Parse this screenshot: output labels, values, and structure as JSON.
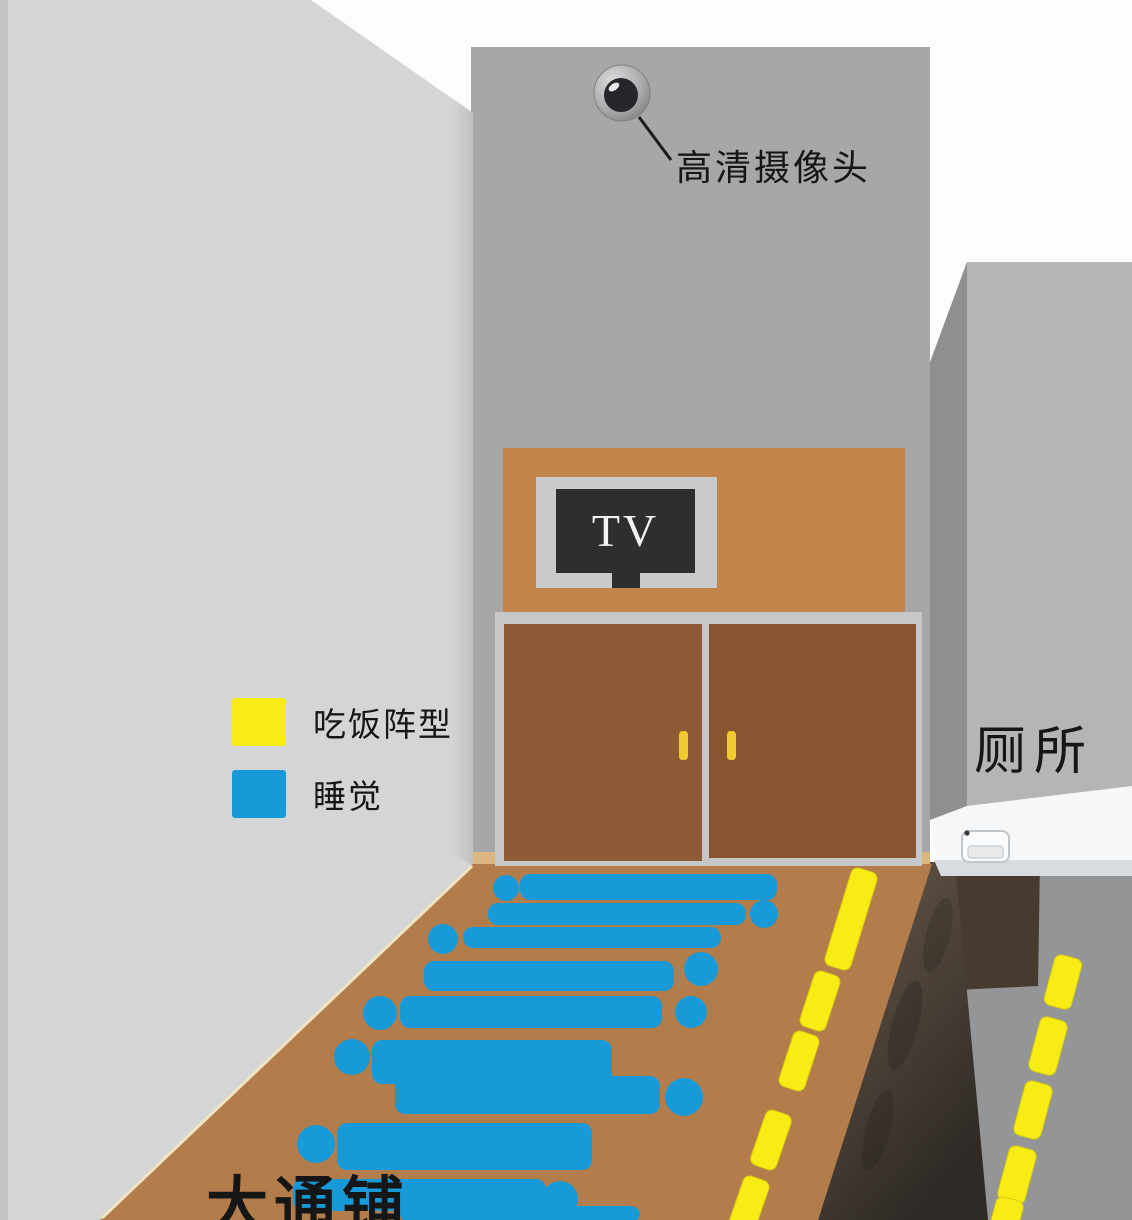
{
  "labels": {
    "camera": "高清摄像头",
    "tv": "TV",
    "toilet": "厕所",
    "communal_bed": "大通铺"
  },
  "legend": {
    "items": [
      {
        "label": "吃饭阵型",
        "color_key": "eat_yellow"
      },
      {
        "label": "睡觉",
        "color_key": "sleep_blue"
      }
    ]
  },
  "colors": {
    "background": "#fdfdfd",
    "wall_left": "#d4d5d7",
    "wall_left_edge": "#c3c4c6",
    "wall_back": "#a6a7a9",
    "wall_right_front": "#b4b5b7",
    "wall_right_side": "#8e8f91",
    "tv_panel": "#c28449",
    "tv_bezel": "#c9cacc",
    "tv_screen": "#2d2e30",
    "door_frame": "#c6c7c9",
    "door_left": "#8d5c37",
    "door_right": "#875631",
    "door_handle": "#f0cb30",
    "floor": "#b27d4b",
    "floor_sill": "#dcb67f",
    "floor_edge_highlight": "#f0e4c2",
    "under_counter": "#473b2f",
    "ground": "#939597",
    "counter": "#f5f7f9",
    "counter_edge": "#d9dcde",
    "toilet_body": "#fbfcfd",
    "toilet_inner": "#e8eaec",
    "sleep_blue": "#189ad8",
    "eat_yellow": "#f7ed15",
    "camera_lens": "#26272a",
    "text": "#161616"
  },
  "scene": {
    "sleepers": [
      {
        "head": [
          506,
          888,
          13
        ],
        "body": [
          520,
          874,
          257,
          26
        ]
      },
      {
        "body": [
          488,
          903,
          258,
          22
        ],
        "head": [
          764,
          914,
          14
        ]
      },
      {
        "head": [
          443,
          939,
          15
        ],
        "body": [
          463,
          927,
          258,
          21
        ]
      },
      {
        "body": [
          424,
          961,
          250,
          30
        ],
        "head": [
          701,
          969,
          17
        ]
      },
      {
        "head": [
          380,
          1013,
          17
        ],
        "body": [
          400,
          996,
          262,
          32
        ]
      },
      {
        "head": [
          691,
          1012,
          16
        ]
      },
      {
        "head": [
          352,
          1057,
          18
        ],
        "body": [
          372,
          1040,
          240,
          44
        ]
      },
      {
        "body": [
          395,
          1076,
          265,
          38
        ],
        "head": [
          684,
          1097,
          19
        ]
      },
      {
        "head": [
          316,
          1144,
          19
        ],
        "body": [
          337,
          1123,
          255,
          47
        ]
      },
      {
        "body": [
          293,
          1179,
          253,
          32
        ],
        "head": [
          560,
          1199,
          18
        ]
      },
      {
        "body": [
          400,
          1206,
          240,
          16
        ]
      }
    ],
    "eating_dashes": [
      {
        "cx": 851,
        "cy": 919,
        "w": 27,
        "h": 102,
        "angle": 17
      },
      {
        "cx": 820,
        "cy": 1001,
        "w": 27,
        "h": 58,
        "angle": 18
      },
      {
        "cx": 799,
        "cy": 1061,
        "w": 27,
        "h": 58,
        "angle": 18
      },
      {
        "cx": 771,
        "cy": 1140,
        "w": 27,
        "h": 58,
        "angle": 19
      },
      {
        "cx": 749,
        "cy": 1205,
        "w": 27,
        "h": 56,
        "angle": 19
      },
      {
        "cx": 1063,
        "cy": 982,
        "w": 28,
        "h": 52,
        "angle": 15
      },
      {
        "cx": 1048,
        "cy": 1046,
        "w": 28,
        "h": 56,
        "angle": 15
      },
      {
        "cx": 1033,
        "cy": 1110,
        "w": 28,
        "h": 56,
        "angle": 15
      },
      {
        "cx": 1017,
        "cy": 1175,
        "w": 28,
        "h": 56,
        "angle": 15
      },
      {
        "cx": 1004,
        "cy": 1226,
        "w": 28,
        "h": 56,
        "angle": 15
      }
    ]
  }
}
